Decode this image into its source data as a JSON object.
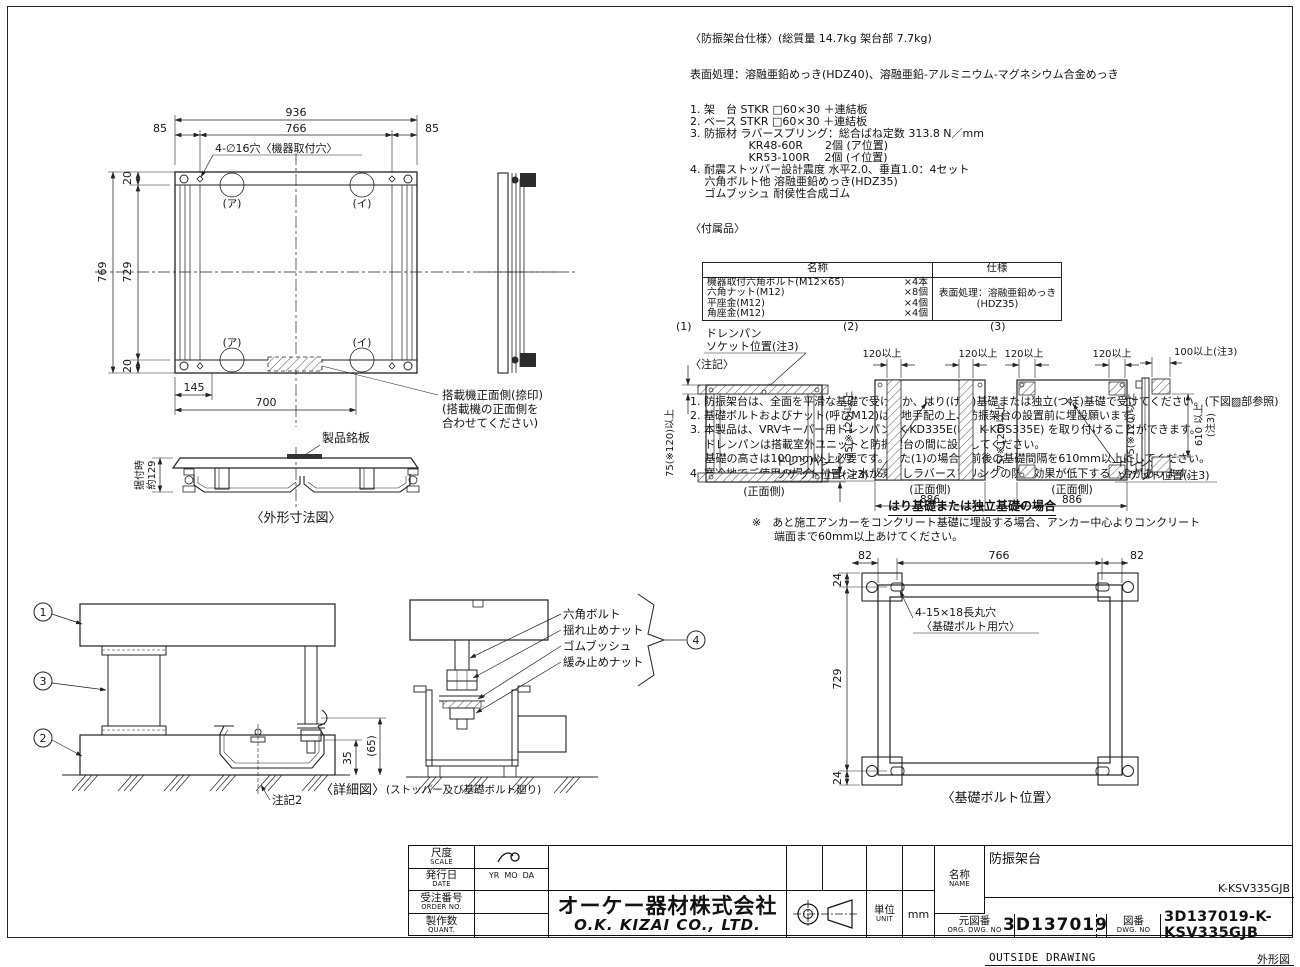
{
  "spec": {
    "title": "〈防振架台仕様〉(総質量 14.7kg 架台部 7.7kg)",
    "surface": "表面処理：溶融亜鉛めっき(HDZ40)、溶融亜鉛-アルミニウム-マグネシウム合金めっき",
    "items": [
      "1. 架　台 STKR □60×30 ＋連結板",
      "2. ベース STKR □60×30 ＋連結板",
      "3. 防振材 ラバースプリング：総合ばね定数 313.8 N／mm",
      "　　　　　 KR48-60R　　2個 (ア位置)",
      "　　　　　 KR53-100R　 2個 (イ位置)",
      "4. 耐震ストッパー設計震度 水平2.0、垂直1.0：4セット",
      "　 六角ボルト他 溶融亜鉛めっき(HDZ35)",
      "　 ゴムブッシュ 耐侯性合成ゴム"
    ]
  },
  "accessories": {
    "title": "〈付属品〉",
    "col_name": "名称",
    "col_spec": "仕様",
    "rows": [
      {
        "name": "機器取付六角ボルト(M12×65)",
        "qty": "×4本"
      },
      {
        "name": "六角ナット(M12)",
        "qty": "×8個"
      },
      {
        "name": "平座金(M12)",
        "qty": "×4個"
      },
      {
        "name": "角座金(M12)",
        "qty": "×4個"
      }
    ],
    "surface1": "表面処理：溶融亜鉛めっき",
    "surface2": "(HDZ35)"
  },
  "notes": {
    "title": "〈注記〉",
    "items": [
      "1. 防振架台は、全面を平滑な基礎で受けるか、はり(げた)基礎または独立(つぼ)基礎で受けてください。(下図▨部参照)",
      "2. 基礎ボルトおよびナット(呼びM12)は現地手配の上、防振架台の設置前に埋設願います。",
      "3. 本製品は、VRVキーパー用ドレンパン (K-KD335E(E)、K-KDS335E) を取り付けることができます。",
      "　 ドレンパンは搭載室外ユニットと防振架台の間に設置してください。",
      "　 基礎の高さは100mm以上必要です。また(1)の場合、前後の基礎間隔を610mm以上にしてください。",
      "4. 寒冷地でご使用の場合、ドレン水が凍結しラバースプリングの防振効果が低下する場合があります。"
    ]
  },
  "plan": {
    "d936": "936",
    "d766": "766",
    "d85": "85",
    "d20": "20",
    "d729": "729",
    "d769": "769",
    "d145": "145",
    "d700": "700",
    "hole_label": "4-∅16穴〈機器取付穴〉",
    "pos_a": "(ア)",
    "pos_i": "(イ)",
    "front1": "搭載機正面側(捺印)",
    "front2": "(搭載機の正面側を",
    "front3": " 合わせてください)",
    "nameplate": "製品銘板",
    "install1": "据付時",
    "install2": "約129",
    "caption": "〈外形寸法図〉"
  },
  "install": {
    "n1": "(1)",
    "n2": "(2)",
    "n3": "(3)",
    "drain1": "ドレンパン",
    "drain2": "ソケット位置(注3)",
    "dim75": "75(※120)以上",
    "dim120": "120以上",
    "dim886": "886",
    "front": "(正面側)",
    "dim100": "100以上(注3)",
    "dim610a": "610 以上",
    "dim610b": "(注3)",
    "caption_hari": "はり基礎または独立基礎の場合",
    "note1": "※　あと施工アンカーをコンクリート基礎に埋設する場合、アンカー中心よりコンクリート",
    "note2": "　　端面まで60mm以上あけてください。"
  },
  "detail": {
    "b1": "1",
    "b2": "2",
    "b3": "3",
    "b4": "4",
    "label1": "六角ボルト",
    "label2": "揺れ止めナット",
    "label3": "ゴムブッシュ",
    "label4": "緩み止めナット",
    "dim35": "35",
    "dim65": "(65)",
    "noteref": "注記2",
    "caption": "〈詳細図〉",
    "caption_sub": "(ストッパー及び基礎ボルト廻り)"
  },
  "boltpos": {
    "d82": "82",
    "d766": "766",
    "d24": "24",
    "d729": "729",
    "hole1": "4-15×18長丸穴",
    "hole2": "〈基礎ボルト用穴〉",
    "caption": "〈基礎ボルト位置〉"
  },
  "titleblock": {
    "scale_jp": "尺度",
    "scale_en": "SCALE",
    "date_jp": "発行日",
    "date_en": "DATE",
    "date_val": "YR  MO  DA",
    "order_jp": "受注番号",
    "order_en": "ORDER NO.",
    "quant_jp": "製作数",
    "quant_en": "QUANT.",
    "company_jp": "オーケー器材株式会社",
    "company_en": "O.K. KIZAI CO., LTD.",
    "unit_jp": "単位",
    "unit_en": "UNIT",
    "unit_val": "mm",
    "name_jp": "名称",
    "name_en": "NAME",
    "name_val": "防振架台",
    "name_sub": "OUTSIDE DRAWING",
    "model": "K-KSV335GJB",
    "model_type": "外形図",
    "org_jp": "元図番",
    "org_en": "ORG. DWG. NO",
    "org_val": "3D137019",
    "dwg_jp": "図番",
    "dwg_en": "DWG. NO",
    "dwg_val": "3D137019-K-KSV335GJB"
  }
}
